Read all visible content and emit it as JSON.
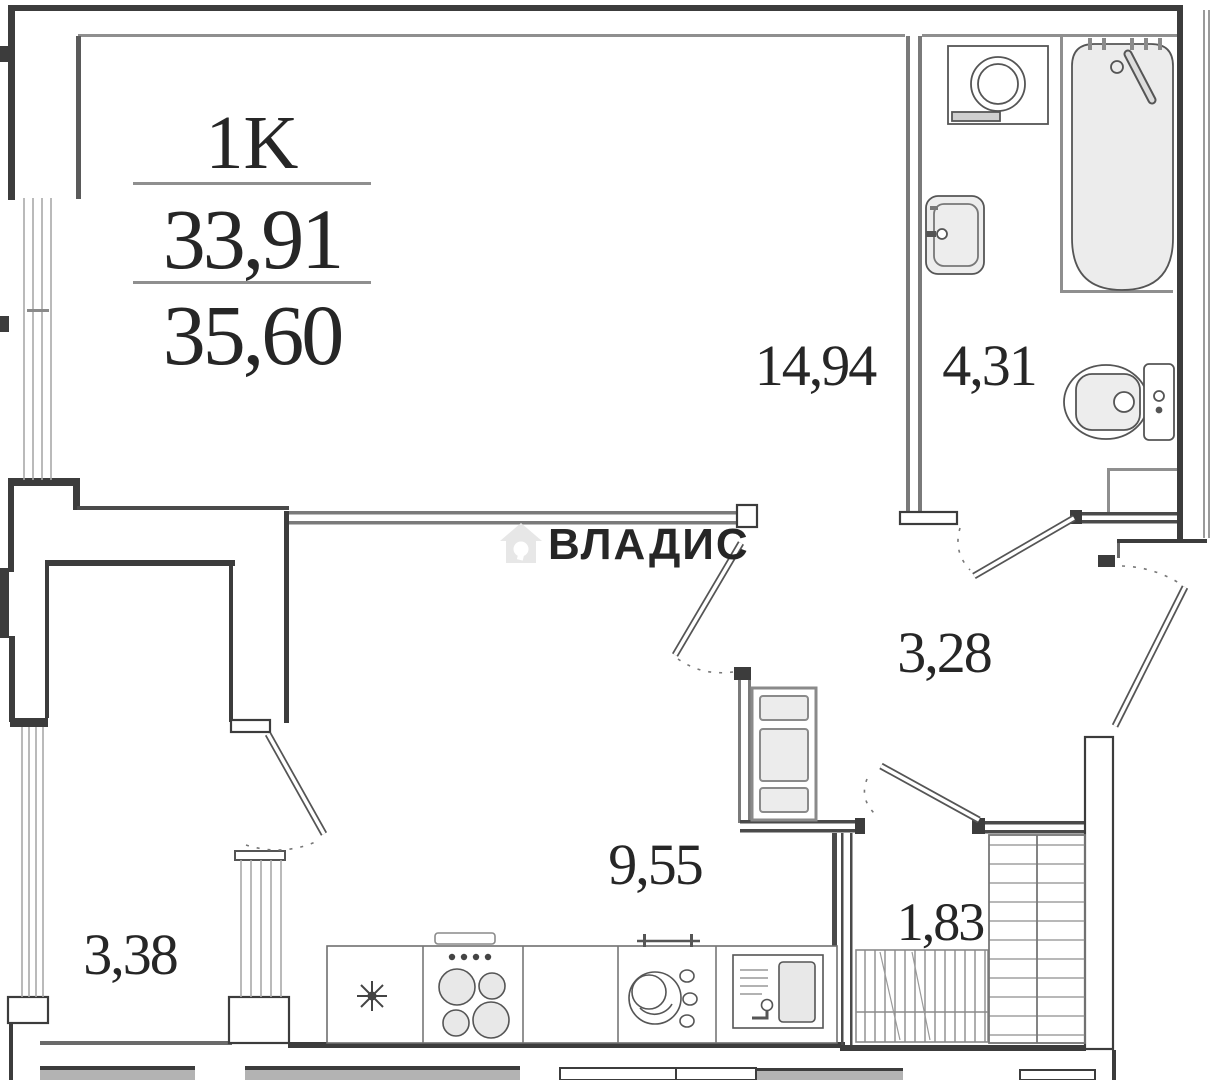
{
  "plan": {
    "unit_type": "1K",
    "living_area": "33,91",
    "total_area": "35,60"
  },
  "rooms": {
    "living": {
      "name": "living-room",
      "area": "14,94"
    },
    "bathroom": {
      "name": "bathroom",
      "area": "4,31"
    },
    "hallway": {
      "name": "hallway",
      "area": "3,28"
    },
    "kitchen": {
      "name": "kitchen",
      "area": "9,55"
    },
    "closet": {
      "name": "closet",
      "area": "1,83"
    },
    "balcony": {
      "name": "balcony",
      "area": "3,38"
    }
  },
  "watermark": {
    "text": "ВЛАДИС",
    "icon": "house-icon"
  },
  "colors": {
    "wall": "#3c3c3c",
    "thin_wall": "#8f8f8f",
    "fixture": "#555555",
    "fixture_fill": "#ececec",
    "watermark": "#e7e7e7",
    "label": "#262626"
  }
}
